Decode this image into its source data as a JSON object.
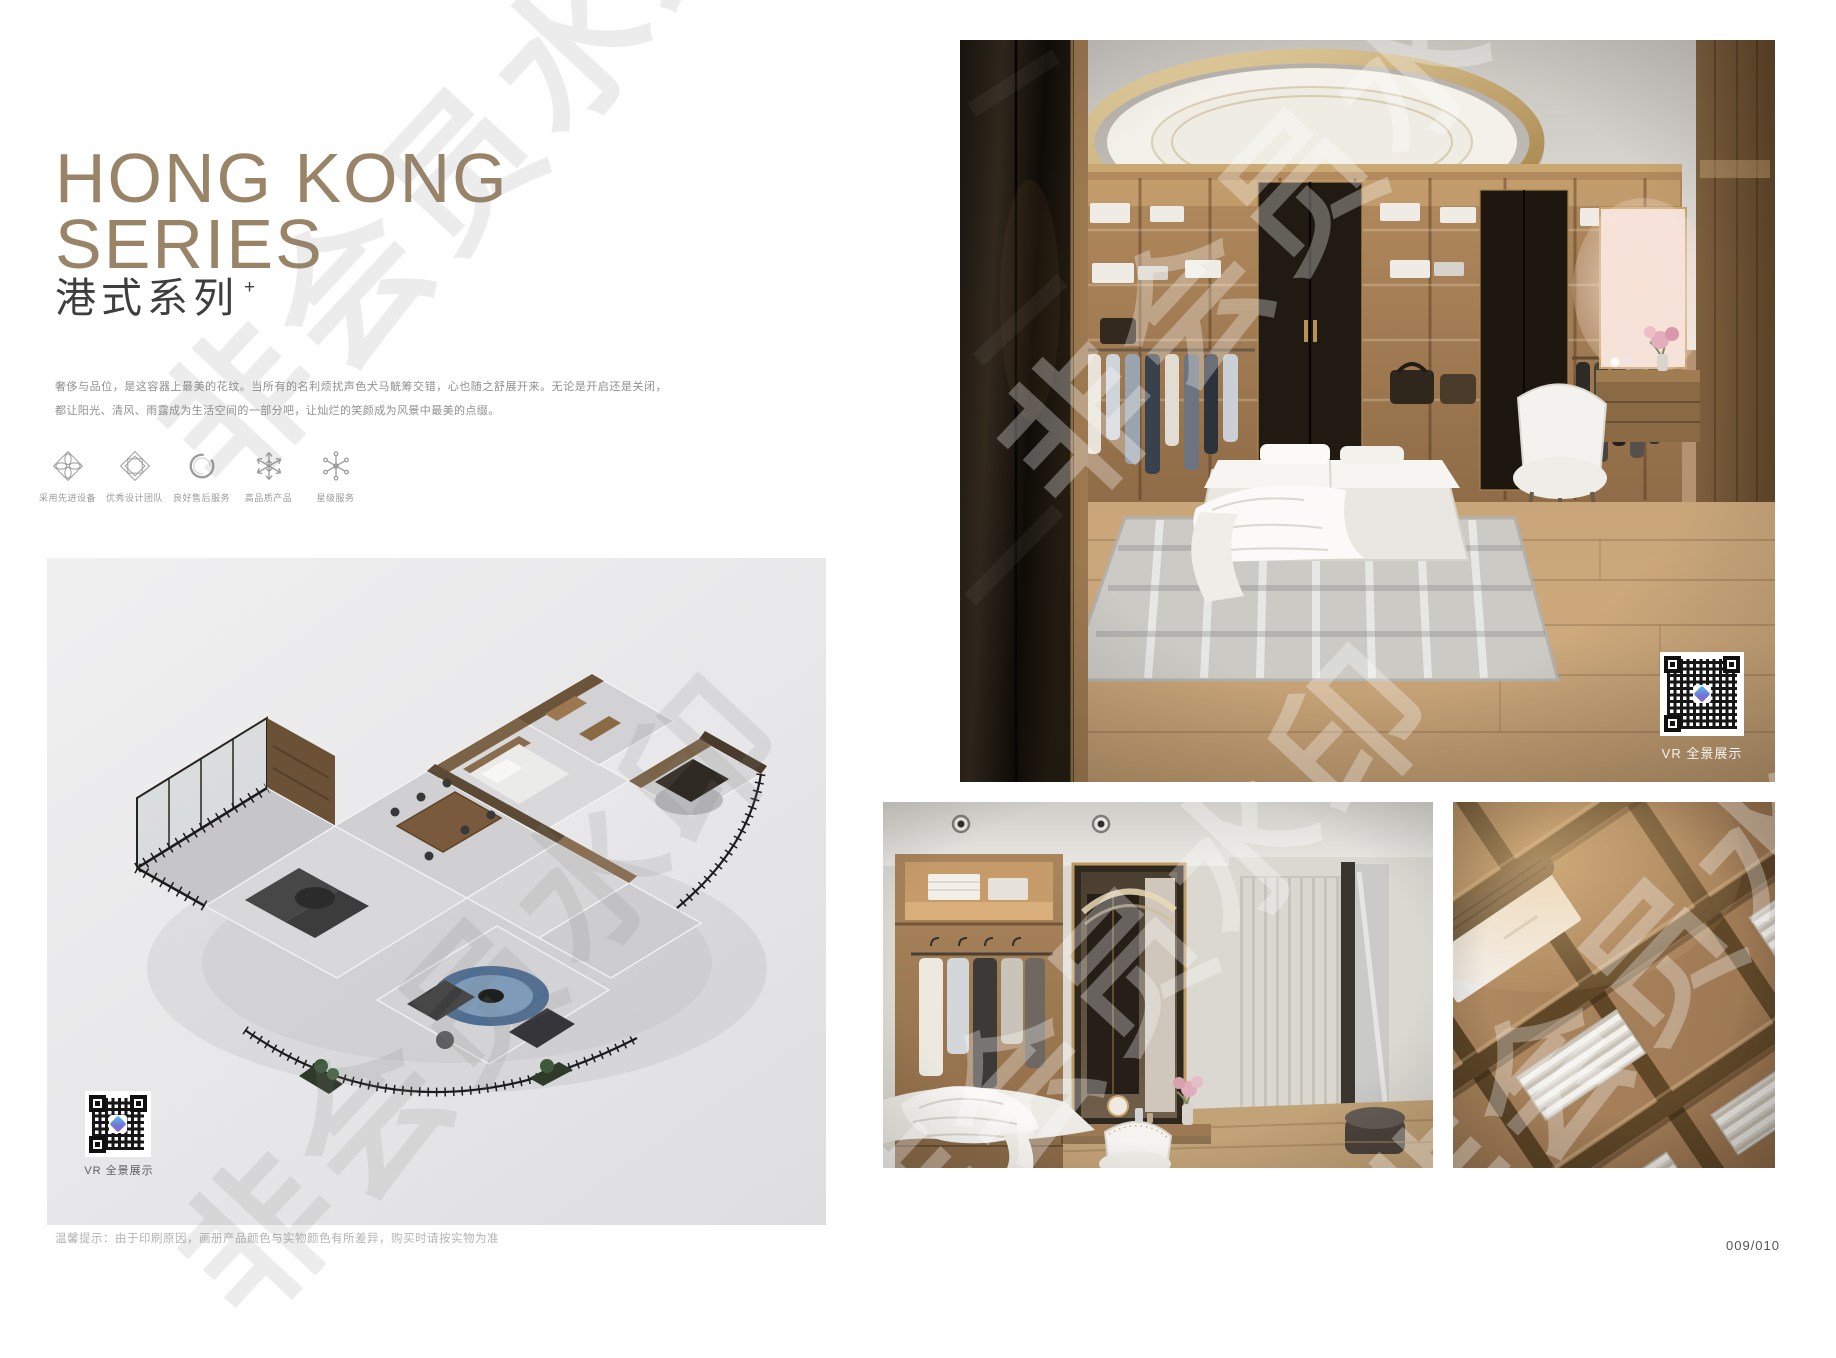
{
  "watermark": {
    "text": "非会员水印"
  },
  "series": {
    "title_line1": "HONG KONG",
    "title_line2": "SERIES",
    "subtitle": "港式系列",
    "subtitle_mark": "+",
    "description": "奢侈与品位，是这容器上最美的花纹。当所有的名利烦扰声色犬马觥筹交错，心也随之舒展开来。无论是开启还是关闭，都让阳光、清风、雨露成为生活空间的一部分吧，让灿烂的笑颜成为风景中最美的点缀。"
  },
  "features": [
    {
      "icon": "advanced-equipment-icon",
      "label": "采用先进设备"
    },
    {
      "icon": "design-team-icon",
      "label": "优秀设计团队"
    },
    {
      "icon": "after-sales-icon",
      "label": "良好售后服务"
    },
    {
      "icon": "quality-product-icon",
      "label": "高品质产品"
    },
    {
      "icon": "star-service-icon",
      "label": "星级服务"
    }
  ],
  "vr": {
    "label": "VR 全景展示"
  },
  "footer": {
    "disclaimer": "温馨提示：由于印刷原因，画册产品颜色与实物颜色有所差异，购买时请按实物为准",
    "page_number": "009/010"
  },
  "colors": {
    "title_bronze": "#9a8468",
    "panel_gray": "#e9e9ea",
    "wood": "#b5916a",
    "gold_trim": "#b99157",
    "text_gray": "#8f8f8f"
  }
}
